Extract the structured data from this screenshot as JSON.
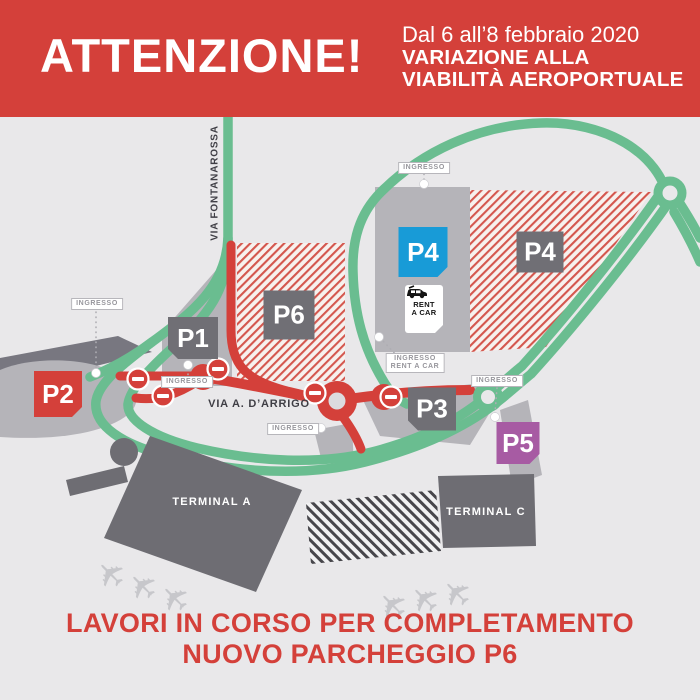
{
  "banner": {
    "title": "ATTENZIONE!",
    "date_line": "Dal 6 all’8 febbraio 2020",
    "subtitle_line1": "VARIAZIONE ALLA",
    "subtitle_line2": "VIABILITÀ AEROPORTUALE"
  },
  "roads": {
    "fontanarossa": "VIA FONTANAROSSA",
    "darrigo": "VIA A. D’ARRIGO"
  },
  "parkings": [
    {
      "id": "p1",
      "label": "P1"
    },
    {
      "id": "p2",
      "label": "P2"
    },
    {
      "id": "p3",
      "label": "P3"
    },
    {
      "id": "p4_open",
      "label": "P4"
    },
    {
      "id": "p4_closed",
      "label": "P4"
    },
    {
      "id": "p5",
      "label": "P5"
    },
    {
      "id": "p6",
      "label": "P6"
    }
  ],
  "terminals": [
    {
      "label": "TERMINAL A"
    },
    {
      "label": "TERMINAL C"
    }
  ],
  "rent_a_car": {
    "line1": "RENT",
    "line2": "A CAR"
  },
  "entrances": [
    {
      "label": "INGRESSO"
    },
    {
      "label": "INGRESSO"
    },
    {
      "label": "INGRESSO"
    },
    {
      "label": "INGRESSO"
    },
    {
      "label": "INGRESSO",
      "label2": "RENT A CAR"
    },
    {
      "label": "INGRESSO"
    }
  ],
  "footer": {
    "line1": "LAVORI IN CORSO PER COMPLETAMENTO",
    "line2": "NUOVO PARCHEGGIO P6"
  },
  "icons": {
    "plane": "✈"
  },
  "colors": {
    "banner_red": "#d4403a",
    "open_road_green": "#6abd90",
    "closed_road_red": "#d4403a",
    "parking_gray": "#b5b4b9",
    "dark_gray": "#706f75",
    "p4_blue": "#189bd7",
    "p5_purple": "#a75ba3",
    "background": "#e9e8ea"
  }
}
